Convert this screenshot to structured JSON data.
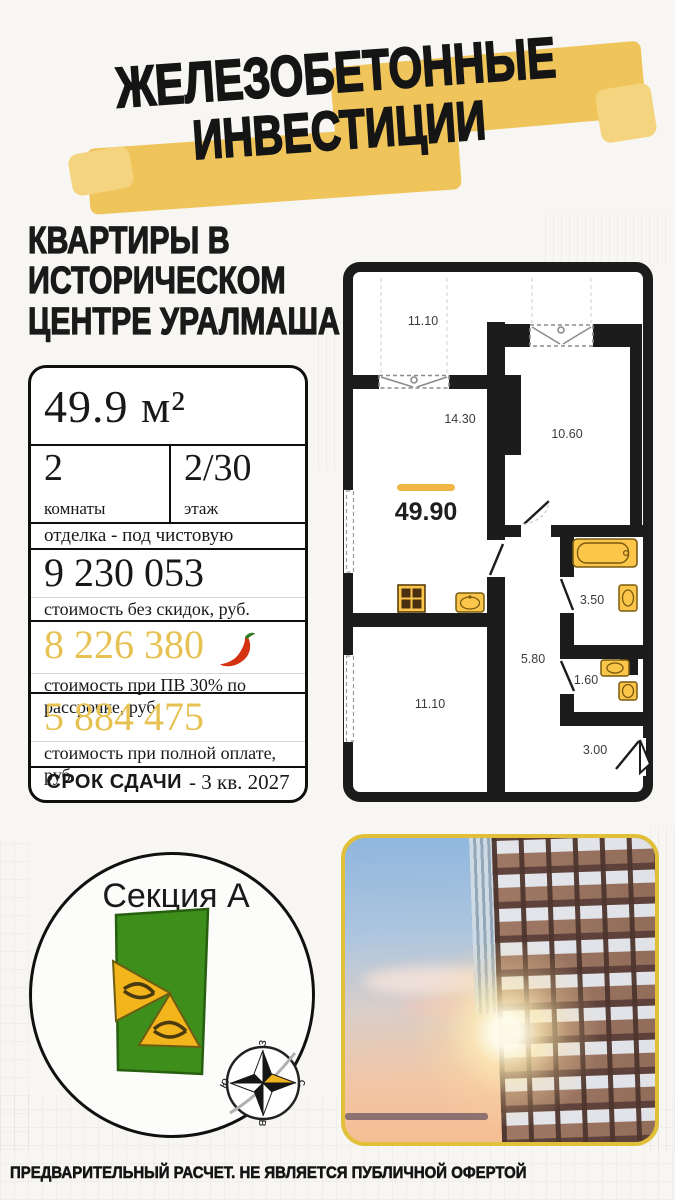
{
  "title": {
    "line1": "ЖЕЛЕЗОБЕТОННЫЕ",
    "line2": "ИНВЕСТИЦИИ"
  },
  "subtitle": [
    "КВАРТИРЫ В",
    "ИСТОРИЧЕСКОМ",
    "ЦЕНТРЕ УРАЛМАША"
  ],
  "card": {
    "area": "49.9 м²",
    "rooms": {
      "value": "2",
      "label": "комнаты"
    },
    "floor": {
      "value": "2/30",
      "label": "этаж"
    },
    "finishing": "отделка - под чистовую",
    "price_base": {
      "value": "9 230 053",
      "label": "стоимость без скидок, руб."
    },
    "price_installment": {
      "value": "8 226 380",
      "label": "стоимость при ПВ 30% по рассрочке, руб."
    },
    "price_cash": {
      "value": "5 884 475",
      "label": "стоимость при полной оплате, руб."
    },
    "deadline": {
      "label": "СРОК СДАЧИ",
      "value": "- 3 кв. 2027"
    }
  },
  "plan": {
    "area_label": "49.90",
    "rooms": {
      "balcony": "11.10",
      "living": "14.30",
      "bedroom": "10.60",
      "hallway": "5.80",
      "bathroom": "3.50",
      "wc": "1.60",
      "bedroom2": "11.10",
      "entry": "3.00"
    }
  },
  "section": {
    "title": "Секция А",
    "compass": {
      "n": "с",
      "s": "ю",
      "w": "з",
      "e": "в"
    }
  },
  "footer": "ПРЕДВАРИТЕЛЬНЫЙ РАСЧЕТ. НЕ ЯВЛЯЕТСЯ ПУБЛИЧНОЙ ОФЕРТОЙ",
  "icons": {
    "hot_price": "chili-pepper",
    "compass": "compass-rose"
  },
  "colors": {
    "highlight_yellow": "#efc45a",
    "price_yellow": "#e7c253",
    "wall_black": "#1c1c1c",
    "fixture_yellow": "#fbc64a",
    "building_green": "#3e8e1b",
    "photo_border_yellow": "#e2bf39"
  }
}
